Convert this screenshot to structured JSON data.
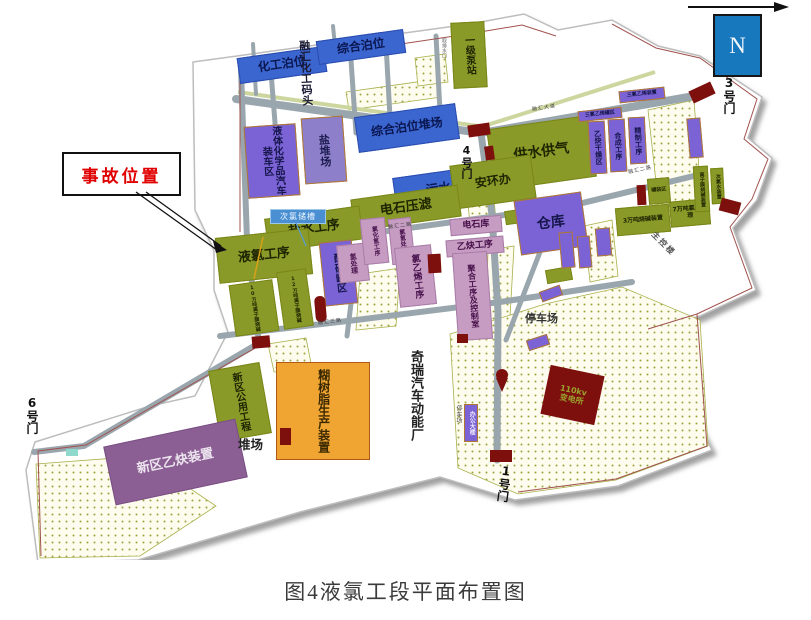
{
  "figure": {
    "caption": "图4液氯工段平面布置图"
  },
  "compass": {
    "label": "N"
  },
  "callout": {
    "accident": "事故位置",
    "hypochlorite": "次氯储槽"
  },
  "gates": {
    "g1": "1号门",
    "g3": "3号门",
    "g4": "4号门",
    "g6": "6号门"
  },
  "roads": {
    "avenue": "融汇大道",
    "road2": "融汇二路",
    "road3": "融汇三路"
  },
  "areas": {
    "hg": "化工泊位",
    "wharf": "融汇化工码头",
    "zh": "综合泊位",
    "pump": "一级泵站",
    "intake": "取排水口",
    "zhd": "综合泊位堆场",
    "salt_yard": "盐堆场",
    "truck": "液体化学品汽车装车区",
    "water_gas": "供水供气",
    "safety": "安环办",
    "sewage": "污水处理",
    "carbide_filter": "电石压滤",
    "brine": "盐水工序",
    "liquid_chlorine": "液氯工序",
    "acid_tank": "酸碱罐区",
    "h2_treat": "氢处理",
    "hcl": "氯化氢工序",
    "clh2": "氯氢处理",
    "vcm": "氯乙烯工序",
    "poly": "聚合工序及控制室",
    "carbide_store": "电石库",
    "acetylene": "乙炔工序",
    "warehouse": "仓库",
    "dry": "乙炔干燥区",
    "synth": "合成工序",
    "refine": "精制工序",
    "tce_tank": "三氯乙烯罐区",
    "tce_unit": "三氯乙烯装置",
    "caustic3": "3万吨烧碱装置",
    "clh7": "7万吨氯氢处理",
    "membrane": "离子膜烧碱装置",
    "hypo_unit": "次氯水装置",
    "filling": "罐装区",
    "caustic10": "10万吨离子膜烧碱",
    "caustic12": "12万吨离子膜烧碱",
    "control": "主控楼",
    "parking1": "停车场",
    "parking2": "停车场",
    "office": "办公大楼",
    "chery": "奇瑞汽车动能厂",
    "substation_l1": "110kv",
    "substation_l2": "变电所",
    "new_acetylene": "新区乙炔装置",
    "yard": "堆场",
    "resin": "糊树脂生产装置",
    "new_utility": "新区公用工程"
  },
  "colors": {
    "olive": "#8a9a28",
    "blue": "#3b66d0",
    "purple": "#7b63d6",
    "pink": "#c79cc3",
    "mauve": "#8b5f94",
    "orange": "#f0a432",
    "dark_red": "#7d100d",
    "road_gray": "#9aa6ad",
    "accident_text": "#e00000",
    "north_box": "#1878be"
  }
}
